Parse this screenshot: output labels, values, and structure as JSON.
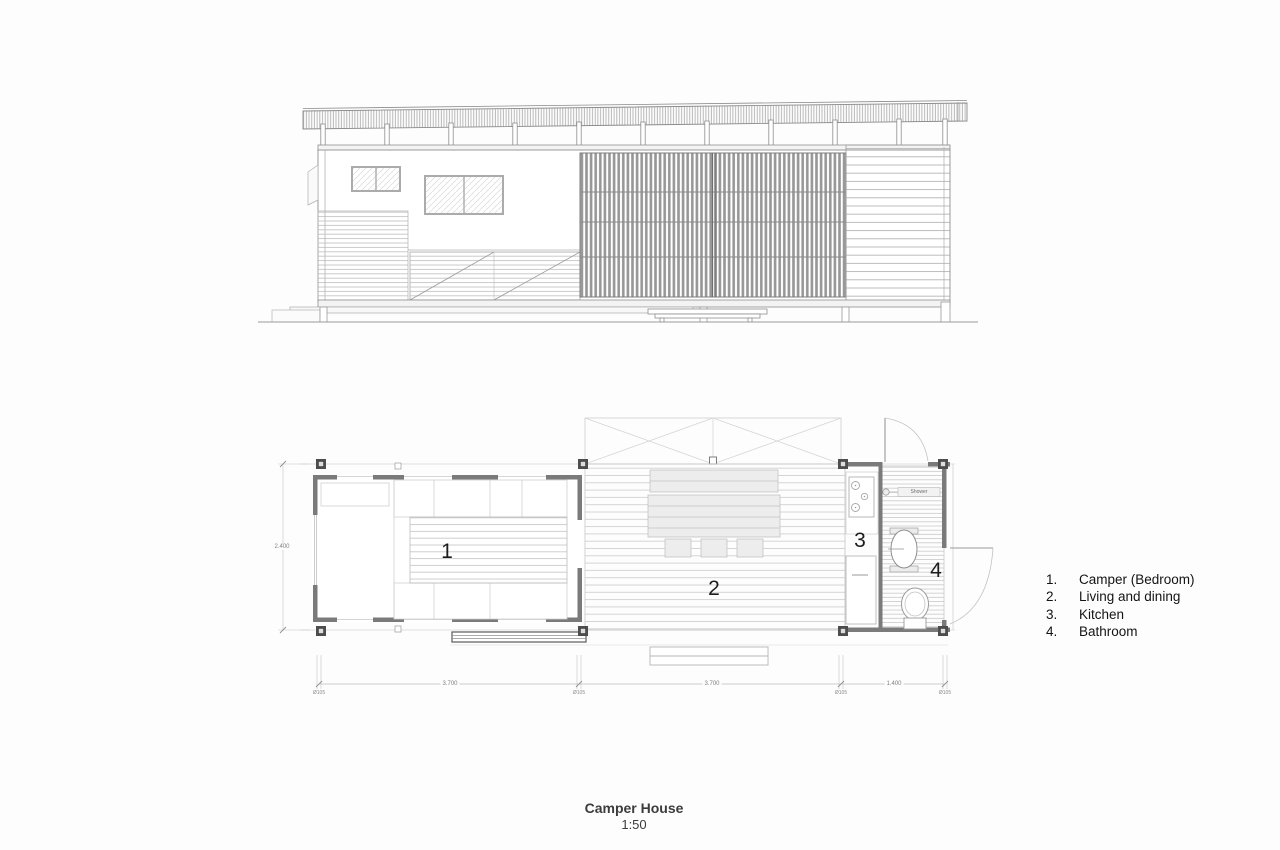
{
  "title_block": {
    "title": "Camper House",
    "scale": "1:50"
  },
  "legend": {
    "items": [
      {
        "number": "1.",
        "label": "Camper (Bedroom)"
      },
      {
        "number": "2.",
        "label": "Living and dining"
      },
      {
        "number": "3.",
        "label": "Kitchen"
      },
      {
        "number": "4.",
        "label": "Bathroom"
      }
    ]
  },
  "floor_plan": {
    "room_labels": {
      "camper": "1",
      "living_dining": "2",
      "kitchen": "3",
      "bathroom": "4"
    },
    "fixtures": {
      "shower_label": "Shower"
    },
    "dimensions": {
      "camper_width_m": "3.700",
      "living_width_m": "3.700",
      "bathroom_width_m": "1.400",
      "plan_depth_m": "2.400",
      "post_diameter": "Ø105"
    }
  },
  "colors": {
    "wall": "#7a7a7a",
    "post": "#4d4d4d",
    "line_mid": "#8f8f8f",
    "line_light": "#c6c6c6",
    "text": "#1c1c1c"
  }
}
